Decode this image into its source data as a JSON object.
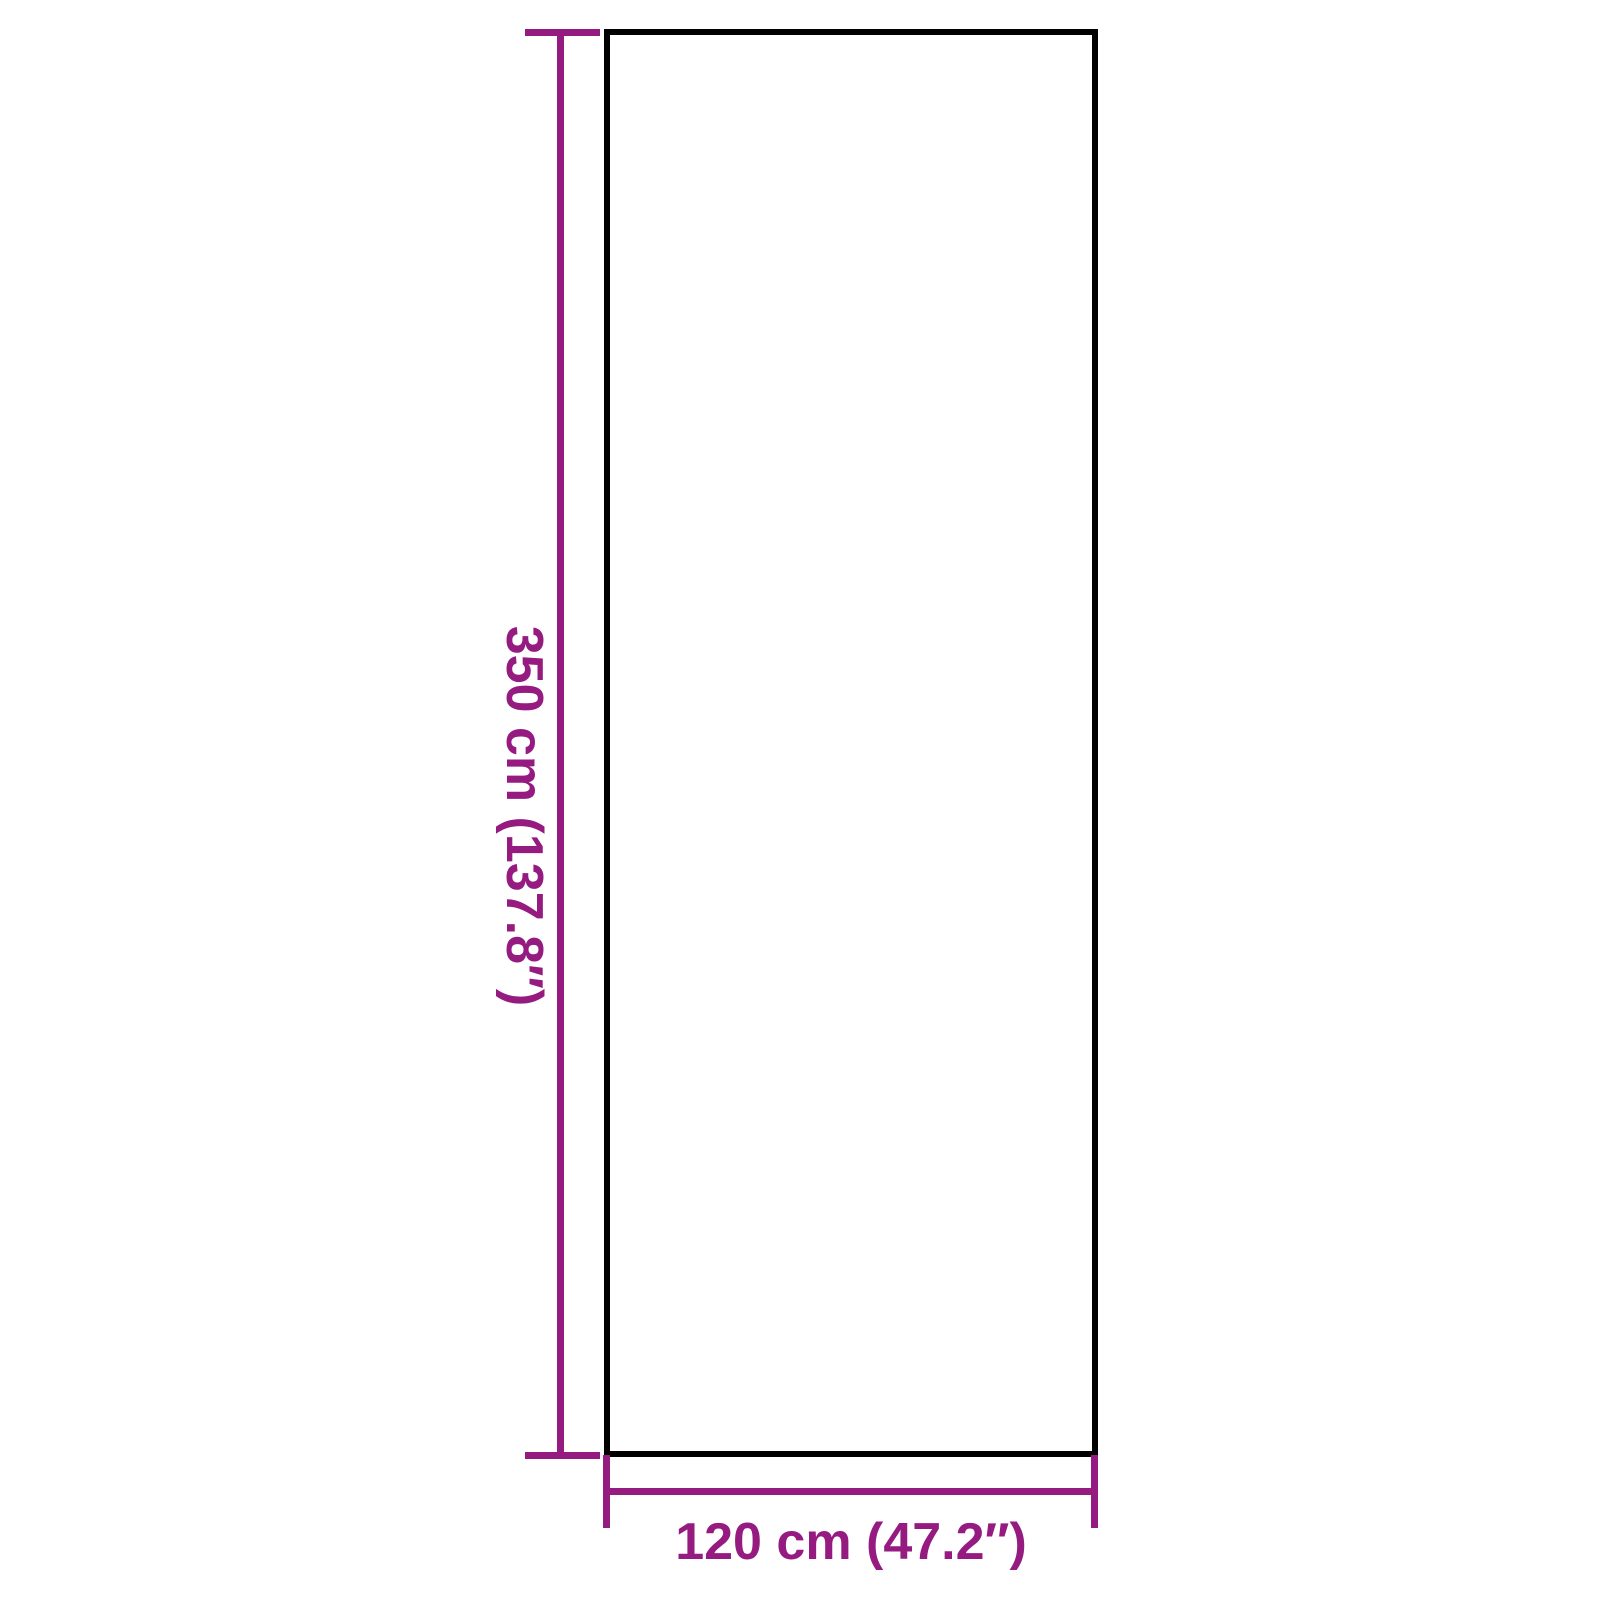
{
  "colors": {
    "accent": "#951B81",
    "outline": "#000000",
    "background": "#FFFFFF"
  },
  "diagram": {
    "type": "product-dimension-diagram",
    "shape": "rectangle",
    "height_dimension": {
      "label": "350 cm (137.8″)",
      "value_cm": 350,
      "value_inches": 137.8,
      "orientation": "vertical",
      "label_rotation": "90deg-clockwise-reads-top-to-bottom"
    },
    "width_dimension": {
      "label": "120 cm (47.2″)",
      "value_cm": 120,
      "value_inches": 47.2,
      "orientation": "horizontal"
    }
  }
}
